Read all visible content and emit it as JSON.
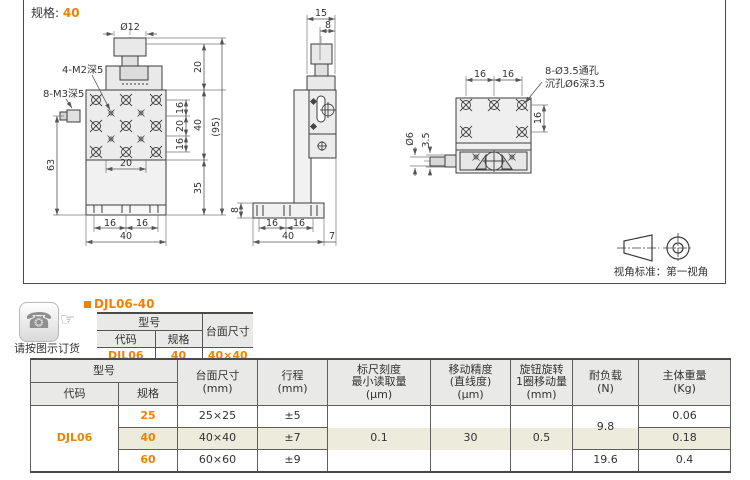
{
  "colors": {
    "accent": "#F08200",
    "row_highlight": "#EDEBDB",
    "table_header_bg": "#E9E9E7"
  },
  "icons": {
    "phone_glyph": "☎",
    "hand_glyph": "☞"
  },
  "drawing": {
    "spec_label": "规格:",
    "spec_value": "40",
    "projection_note": "视角标准：第一视角",
    "front": {
      "knob_dia": "Ø12",
      "thread_label_top": "4-M2深5",
      "thread_label_side": "8-M3深5",
      "knob_height": "20",
      "hole_span_top": "16",
      "hole_span_mid": "20",
      "hole_span_bot": "16",
      "plate_height": "40",
      "overall_height": "(95)",
      "body_height": "63",
      "slot_span": "20",
      "base_height": "35",
      "foot_span_left": "16",
      "foot_span_right": "16",
      "base_width": "40"
    },
    "side": {
      "head_width": "15",
      "knob_offset": "8",
      "base_thickness": "8",
      "foot_span_left": "16",
      "foot_span_right": "16",
      "base_width": "40",
      "overhang": "7"
    },
    "top": {
      "hole_span_left": "16",
      "hole_span_right": "16",
      "hole_note_line1": "8-Ø3.5通孔",
      "hole_note_line2": "沉孔Ø6深3.5",
      "hole_span_vert": "16",
      "shaft_dia": "Ø6",
      "shaft_step": "3.5"
    }
  },
  "order": {
    "note": "请按图示订货",
    "title": "DJL06-40",
    "table": {
      "model_header": "型号",
      "code_header": "代码",
      "spec_header": "规格",
      "size_header": "台面尺寸",
      "code": "DJL06",
      "spec": "40",
      "size": "40×40"
    }
  },
  "spec_table": {
    "headers": {
      "model": "型号",
      "code": "代码",
      "spec": "规格",
      "size": "台面尺寸\n(mm)",
      "stroke": "行程\n(mm)",
      "scale": "标尺刻度\n最小读取量\n(μm)",
      "precision": "移动精度\n(直线度)\n(μm)",
      "knob": "旋钮旋转\n1圈移动量\n(mm)",
      "load": "耐负载\n(N)",
      "weight": "主体重量\n(Kg)"
    },
    "code": "DJL06",
    "merged": {
      "scale": "0.1",
      "precision": "30",
      "knob": "0.5",
      "load_upper": "9.8"
    },
    "rows": [
      {
        "spec": "25",
        "size": "25×25",
        "stroke": "±5",
        "weight": "0.06"
      },
      {
        "spec": "40",
        "size": "40×40",
        "stroke": "±7",
        "weight": "0.18"
      },
      {
        "spec": "60",
        "size": "60×60",
        "stroke": "±9",
        "load": "19.6",
        "weight": "0.4"
      }
    ]
  }
}
